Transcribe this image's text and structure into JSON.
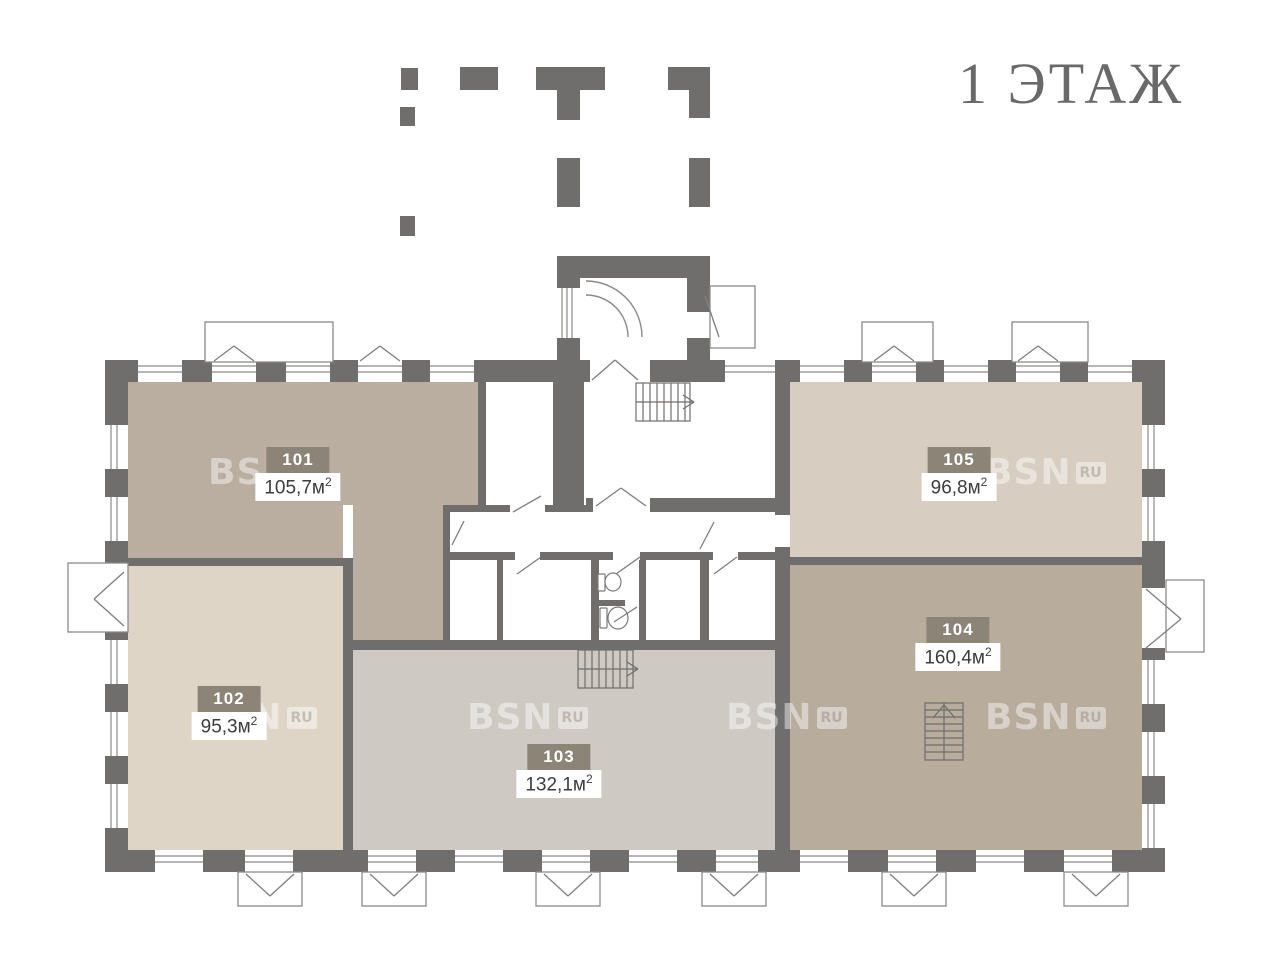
{
  "title": "1 ЭТАЖ",
  "watermark": {
    "bsn": "BSN",
    "ru": "RU"
  },
  "units": [
    {
      "id": "101",
      "area_value": "105,7",
      "unit_base": "м",
      "unit_sup": "2"
    },
    {
      "id": "102",
      "area_value": "95,3",
      "unit_base": "м",
      "unit_sup": "2"
    },
    {
      "id": "103",
      "area_value": "132,1",
      "unit_base": "м",
      "unit_sup": "2"
    },
    {
      "id": "104",
      "area_value": "160,4",
      "unit_base": "м",
      "unit_sup": "2"
    },
    {
      "id": "105",
      "area_value": "96,8",
      "unit_base": "м",
      "unit_sup": "2"
    }
  ],
  "colors": {
    "wall": "#6f6e6c",
    "thin_line": "#8a8a88",
    "room_101": "#b9aea0",
    "room_102": "#ded5c7",
    "room_103": "#cfc9c3",
    "room_104": "#b8ac9d",
    "room_105": "#d7cdc0",
    "label_badge": "#8d8478",
    "label_number_text": "#ffffff",
    "area_text": "#3c3c3e",
    "title_text": "#696969"
  }
}
